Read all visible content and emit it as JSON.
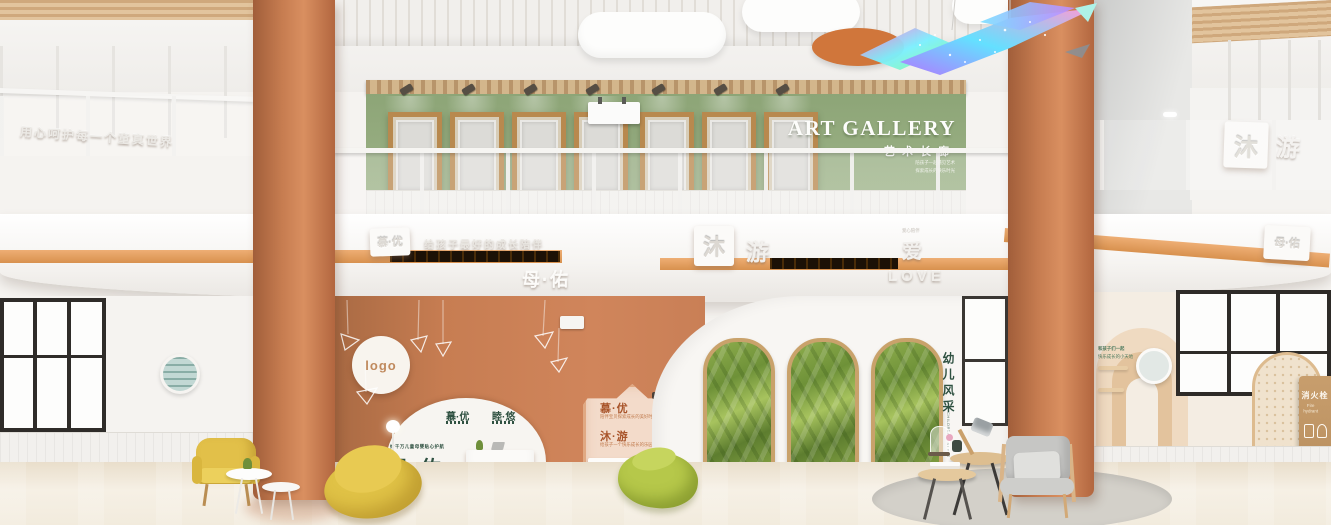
{
  "gallery": {
    "title": "ART GALLERY",
    "subtitle": "艺术长廊",
    "tagline1": "陪孩子一起遇见艺术",
    "tagline2": "探索成长的快乐时光"
  },
  "mezzanine": {
    "left_slogan": "用心呵护每一个童真世界",
    "left_badge": "慕·优",
    "left_embossed": "给孩子最好的成长陪伴",
    "center_tile": "沐",
    "center_char": "游",
    "right_tile": "沐",
    "right_char": "游"
  },
  "beam": {
    "brand": "母·佑",
    "love_char": "爱",
    "love_char_caption": "爱心陪伴",
    "love_word": "LOVE",
    "right_embossed": "MUYOU",
    "right_badge": "母·佑",
    "upper_badge": "慕·优"
  },
  "reception": {
    "logo": "logo",
    "arch_left_title": "慕·优",
    "arch_right_title": "睦·悠",
    "tagline": "给千万儿童母婴贴心护航",
    "brand": "母·佑"
  },
  "house_sign": {
    "item1_title": "慕·优",
    "item1_sub": "陪伴宝贝探索成长的美好时光",
    "item2_title": "沐·游",
    "item2_sub": "给孩子一个快乐成长的乐园"
  },
  "right_wall": {
    "caption1": "和孩子们一起",
    "caption2": "快乐成长的小天地",
    "vertical_title": "幼儿风采",
    "vertical_sub": "CHILDREN'S STYLE",
    "fire_title": "消火栓",
    "fire_sub": "Fire hydrant"
  },
  "colors": {
    "terracotta": "#c97f56",
    "stripe_orange": "#e8a368",
    "wall_green": "#93aa7d",
    "text_green": "#2f5141",
    "frame_wood": "#b8894e",
    "armchair_yellow": "#e0c246",
    "beanbag_lime": "#b6c84a"
  }
}
